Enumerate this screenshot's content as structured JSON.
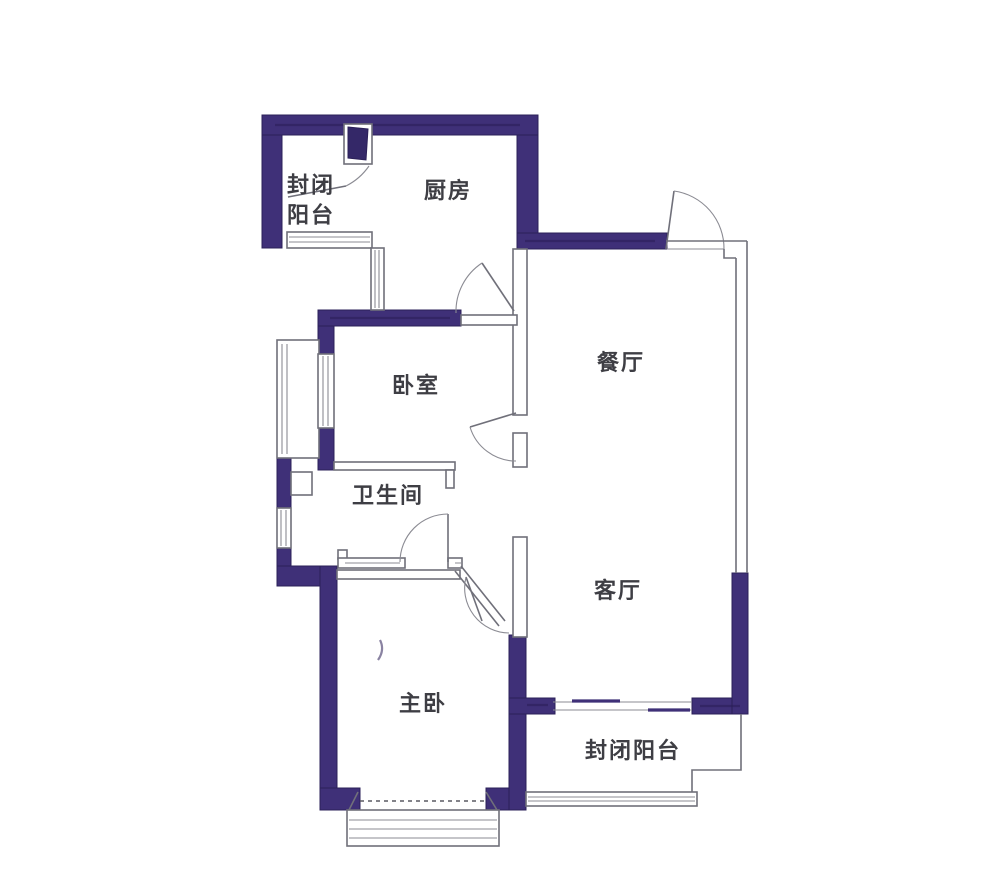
{
  "colors": {
    "wall": "#3f3078",
    "wall_edge": "#2b2058",
    "line": "#70707a",
    "text": "#3e3e44",
    "background": "#ffffff"
  },
  "floorplan": {
    "type": "apartment-floor-plan",
    "rooms": [
      {
        "id": "balcony-top",
        "label": "封闭阳台",
        "label_lines": [
          "封闭",
          "阳台"
        ]
      },
      {
        "id": "kitchen",
        "label": "厨房"
      },
      {
        "id": "dining",
        "label": "餐厅"
      },
      {
        "id": "bedroom",
        "label": "卧室"
      },
      {
        "id": "bathroom",
        "label": "卫生间"
      },
      {
        "id": "living",
        "label": "客厅"
      },
      {
        "id": "master-bedroom",
        "label": "主卧"
      },
      {
        "id": "balcony-bottom",
        "label": "封闭阳台"
      }
    ]
  }
}
